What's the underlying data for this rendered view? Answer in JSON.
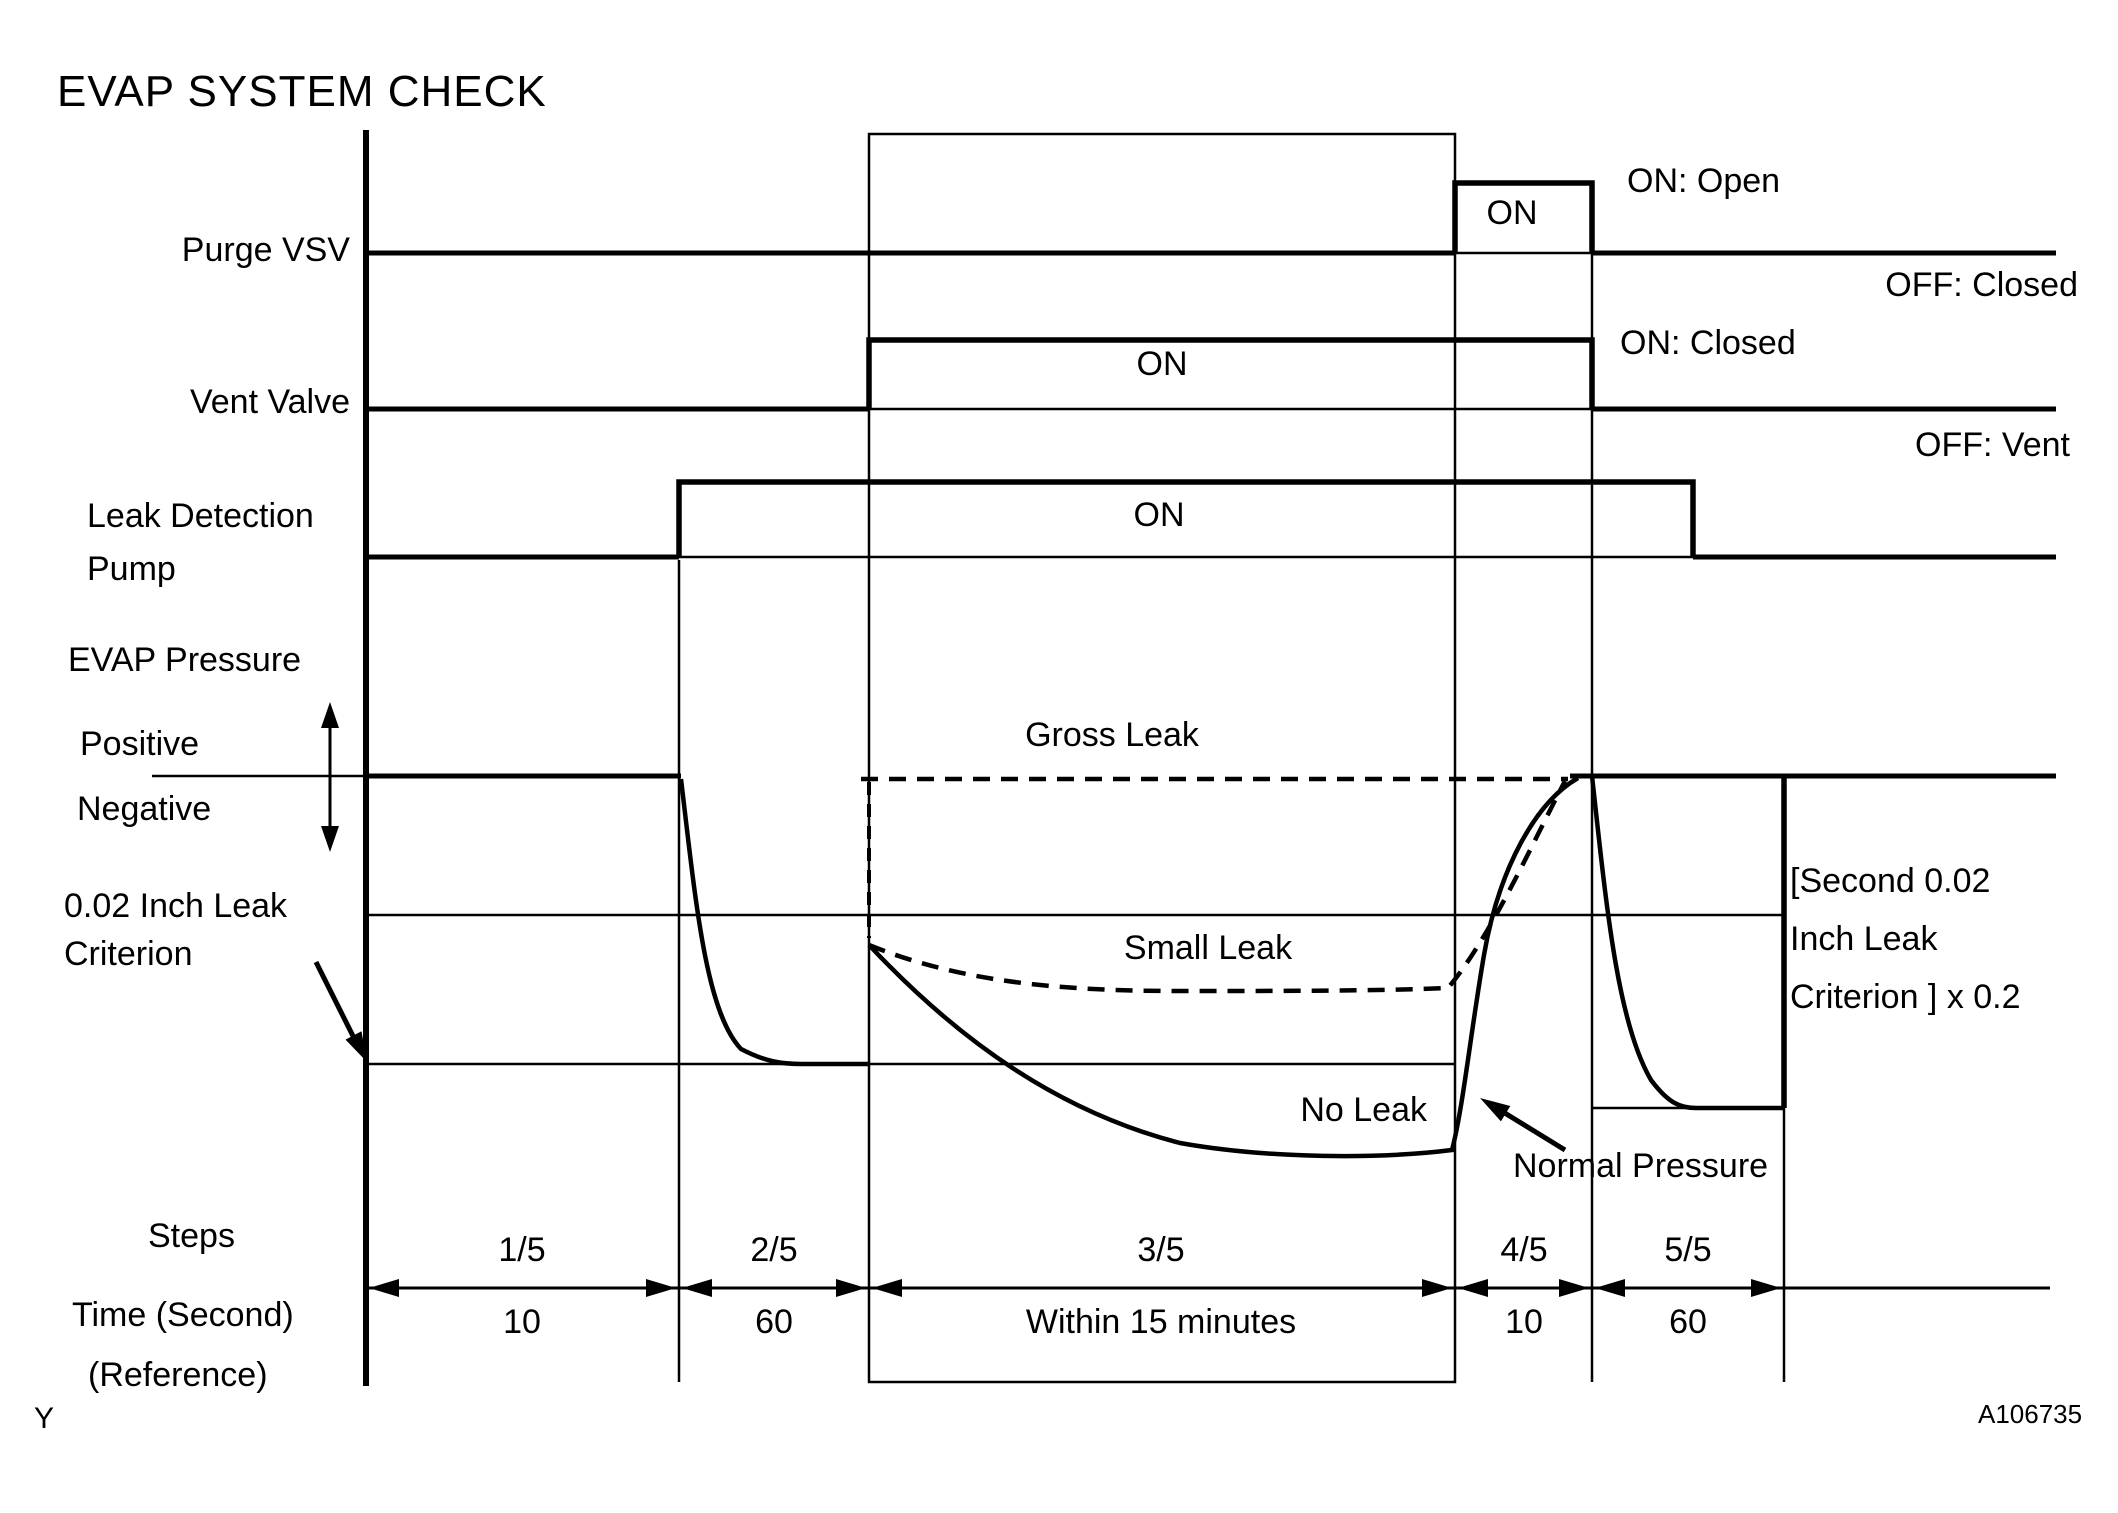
{
  "title": "EVAP SYSTEM CHECK",
  "signals": {
    "purge_vsv": "Purge VSV",
    "vent_valve": "Vent Valve",
    "leak_pump_line1": "Leak Detection",
    "leak_pump_line2": "Pump",
    "evap_pressure": "EVAP Pressure",
    "positive": "Positive",
    "negative": "Negative",
    "criterion_line1": "0.02 Inch Leak",
    "criterion_line2": "Criterion"
  },
  "pulse_labels": {
    "purge_on": "ON",
    "vent_on": "ON",
    "pump_on": "ON"
  },
  "right_annotations": {
    "on_open": "ON: Open",
    "off_closed": "OFF: Closed",
    "on_closed": "ON: Closed",
    "off_vent": "OFF: Vent",
    "second_criterion_l1": "[Second 0.02",
    "second_criterion_l2": "Inch Leak",
    "second_criterion_l3": "Criterion ] x 0.2"
  },
  "curve_labels": {
    "gross_leak": "Gross Leak",
    "small_leak": "Small Leak",
    "no_leak": "No Leak",
    "normal_pressure": "Normal Pressure"
  },
  "bottom_axis": {
    "steps_label": "Steps",
    "time_label": "Time (Second)",
    "reference_label": "(Reference)",
    "step_labels": [
      "1/5",
      "2/5",
      "3/5",
      "4/5",
      "5/5"
    ],
    "time_values": [
      "10",
      "60",
      "Within 15 minutes",
      "10",
      "60"
    ]
  },
  "footer": {
    "figure_id": "A106735",
    "y_marker": "Y"
  },
  "colors": {
    "ink": "#000000",
    "background": "#ffffff"
  }
}
